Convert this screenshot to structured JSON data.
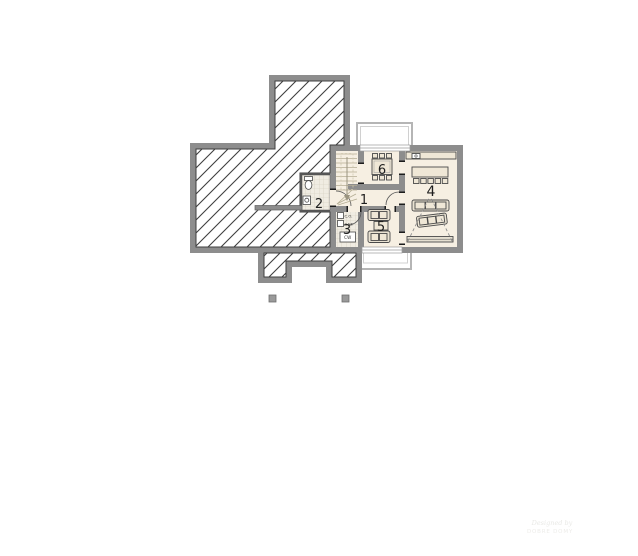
{
  "plan": {
    "type": "architectural-floor-plan",
    "room_numbers": {
      "r1": "1",
      "r2": "2",
      "r3": "3",
      "r4": "4",
      "r5": "5",
      "r6": "6"
    },
    "boiler_labels": {
      "co": "C.O.",
      "gaz": "GAZ",
      "cw": "CW"
    },
    "watermark": {
      "line1": "Designed by",
      "line2": "DOBRE DOMY"
    },
    "colors": {
      "wall": "#8d8d8d",
      "floor": "#f6efe2",
      "hatch_line": "#3f3f3f",
      "tile_floor": "#f0ece2",
      "tile_line": "#d2ccbd",
      "terrace_outline": "#b5b5b5",
      "furniture_fill": "#efe7d6",
      "furniture_stroke": "#4a4a4a"
    }
  }
}
